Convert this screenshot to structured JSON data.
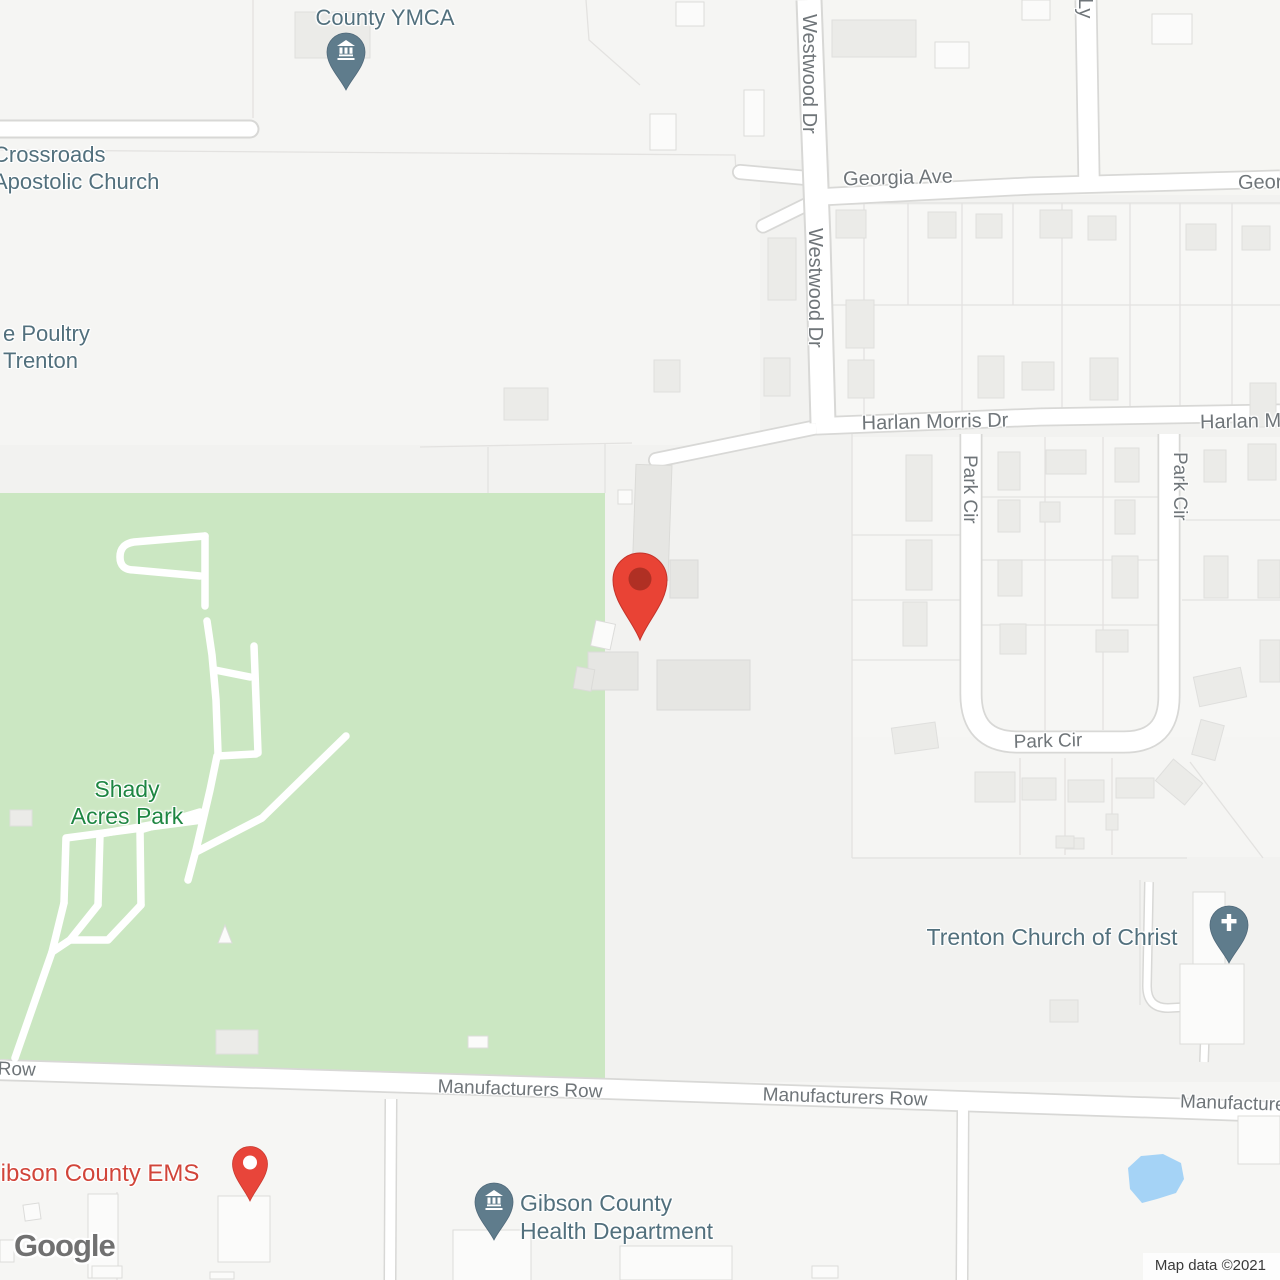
{
  "map": {
    "watermark": "Google",
    "attribution": "Map data ©2021",
    "pois": {
      "ymca": "County YMCA",
      "crossroads_l1": "Crossroads",
      "crossroads_l2": "Apostolic Church",
      "poultry_l1": "e Poultry",
      "poultry_l2": "Trenton",
      "shady_l1": "Shady",
      "shady_l2": "Acres Park",
      "church_of_christ": "Trenton Church of Christ",
      "ems": "Gibson County EMS",
      "health_l1": "Gibson County",
      "health_l2": "Health Department"
    },
    "streets": {
      "westwood": "Westwood Dr",
      "georgia": "Georgia Ave",
      "harlan": "Harlan Morris Dr",
      "park_cir": "Park Cir",
      "manufacturers": "Manufacturers Row",
      "ly": "Ly"
    },
    "icons": {
      "ymca_pin": "museum-icon",
      "health_pin": "museum-icon",
      "church_pin": "cross-icon",
      "ems_pin": "circle-marker-icon",
      "destination_pin": "red-map-pin"
    },
    "colors": {
      "destination_pin": "#E94335",
      "destination_pin_inner": "#B03024",
      "poi_pin": "#5F7C8C",
      "poi_label": "#52707D",
      "street_label": "#6F7579",
      "park_fill": "#CBE7C2",
      "park_label": "#1E8642",
      "ems_label": "#D1453A",
      "water": "#A5D3F6",
      "road_fill": "#FFFFFF"
    }
  }
}
